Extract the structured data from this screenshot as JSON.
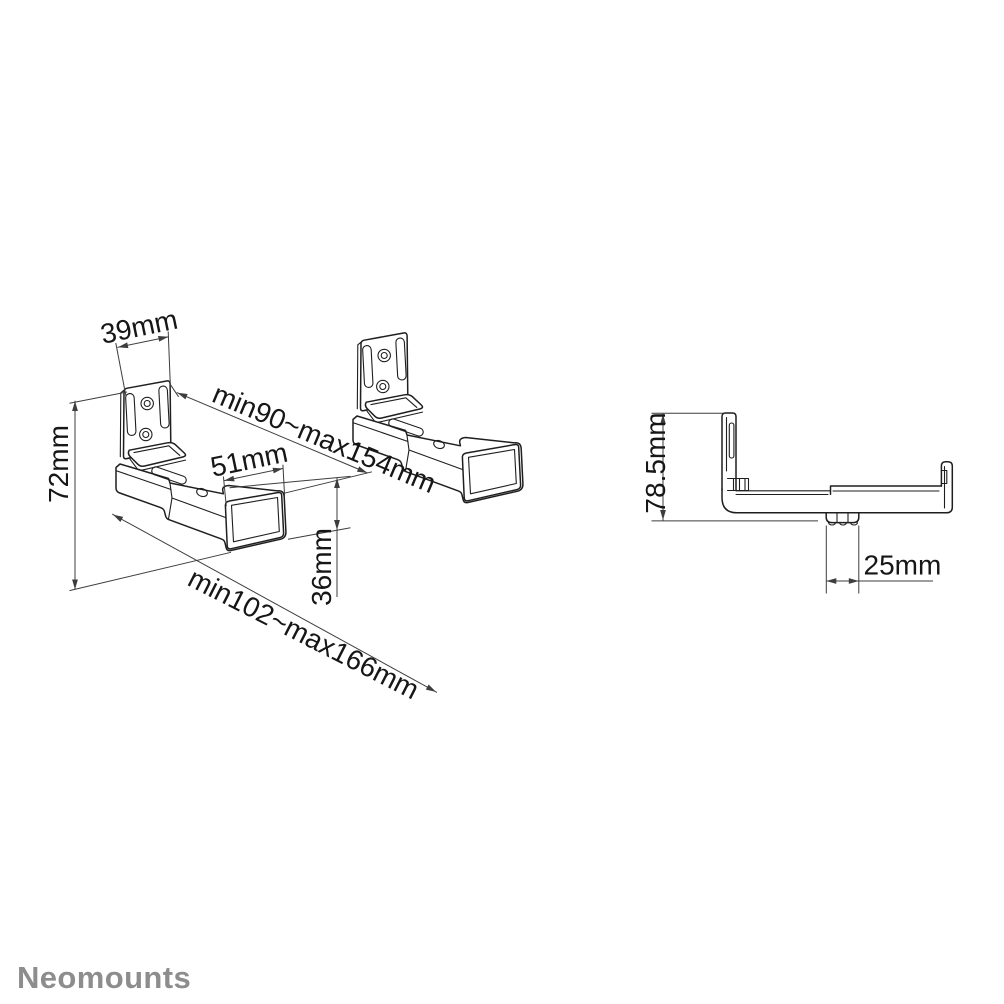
{
  "drawing": {
    "brand": "Neomounts",
    "views": {
      "isometric_front": {
        "dimensions": {
          "plate_width": "39mm",
          "bracket_height": "72mm",
          "inner_width_range": "min90~max154mm",
          "end_cap_width": "51mm",
          "arm_depth": "36mm",
          "outer_width_range": "min102~max166mm"
        }
      },
      "side_profile": {
        "dimensions": {
          "total_height": "78.5mm",
          "knob_offset": "25mm"
        }
      }
    },
    "colors": {
      "object_line": "#1f1f1f",
      "dimension_line": "#3d3d3d",
      "label_text": "#161616",
      "brand_text": "#8d8d8d",
      "background": "#ffffff"
    }
  }
}
